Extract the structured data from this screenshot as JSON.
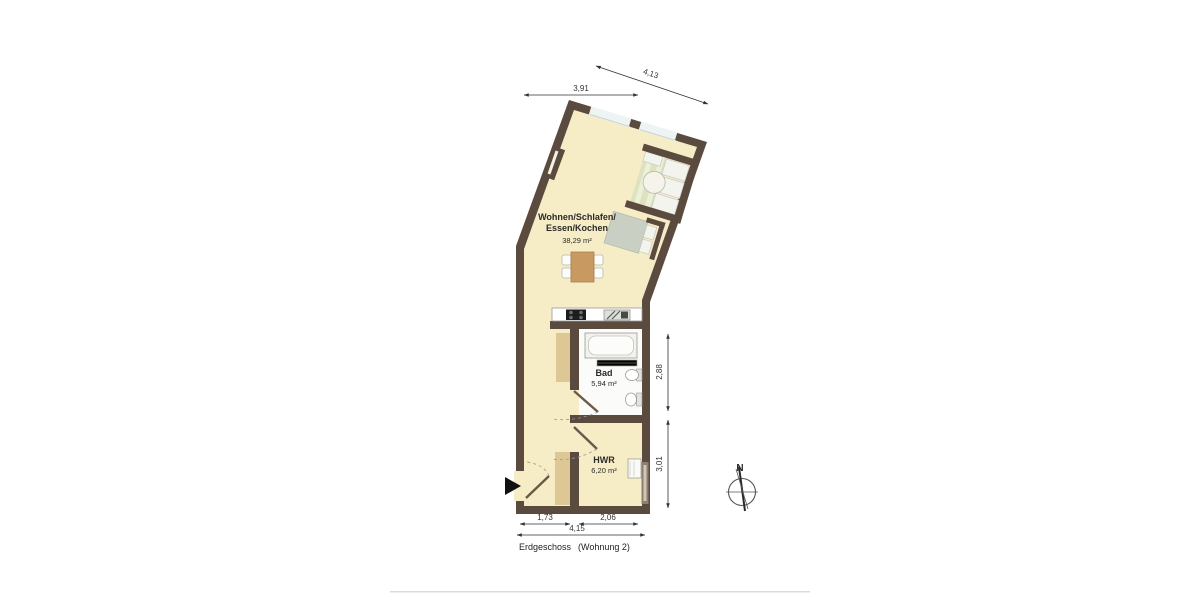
{
  "plan": {
    "rooms": {
      "living": {
        "label_line1": "Wohnen/Schlafen/",
        "label_line2": "Essen/Kochen",
        "area": "38,29 m²"
      },
      "bath": {
        "label": "Bad",
        "area": "5,94 m²"
      },
      "utility": {
        "label": "HWR",
        "area": "6,20 m²"
      }
    },
    "dimensions": {
      "top_width": "3,91",
      "top_slanted": "4,13",
      "right_bath": "2,88",
      "right_utility": "3,01",
      "bottom_hall": "1,73",
      "bottom_utility": "2,06",
      "bottom_total": "4,15"
    },
    "footer": {
      "floor_label": "Erdgeschoss",
      "unit_label": "(Wohnung 2)"
    },
    "compass": {
      "label": "N"
    },
    "colors": {
      "wall": "#5b4a3e",
      "floor": "#f6ecc6",
      "bath_floor": "#fbfbf9",
      "window": "#eef3f3",
      "furniture_wood": "#c89a62",
      "furniture_gray": "#c9cfc2",
      "furniture_green": "#dde3c0",
      "cabinet_tan": "#dcc795",
      "dim_line": "#333333"
    }
  }
}
